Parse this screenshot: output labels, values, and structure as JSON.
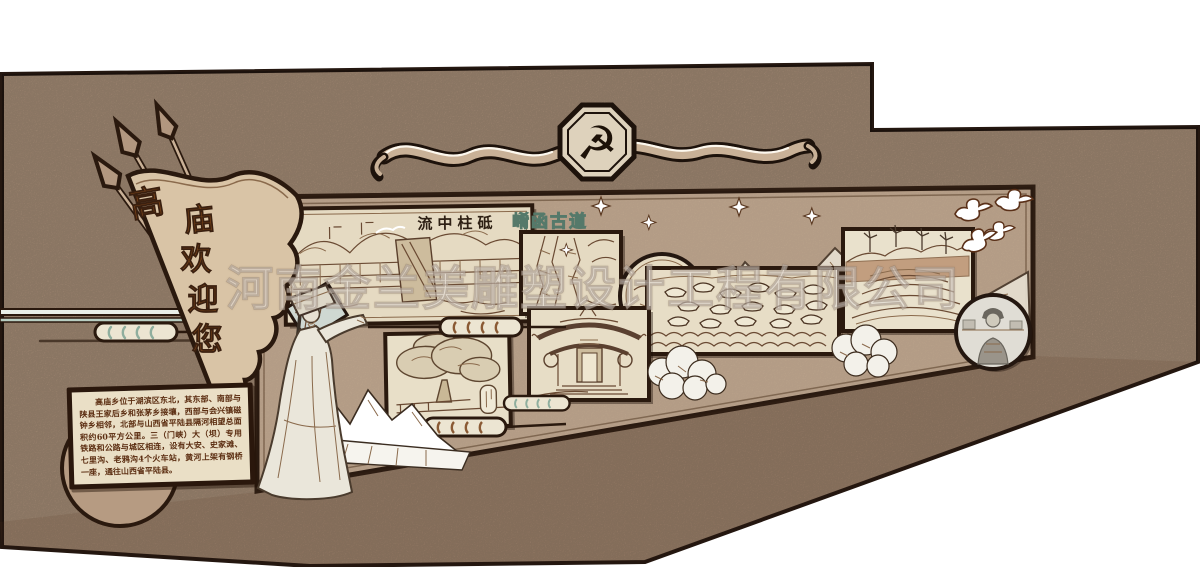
{
  "design": {
    "kind": "cultural-wall-rendering",
    "flag": {
      "text": "高庙欢迎您",
      "chars": [
        "高",
        "庙",
        "欢",
        "迎",
        "您"
      ]
    },
    "emblem": {
      "name": "hammer-and-sickle",
      "glyph": "☭"
    },
    "titles": {
      "dam": "流中柱砥",
      "ancient_road": "崤函古道"
    },
    "intro_panel": {
      "text": "高庙乡位于湖滨区东北，其东部、南部与陕县王家后乡和张茅乡接壤，西部与会兴镇磁钟乡相邻，北部与山西省平陆县隔河相望总面积约60平方公里。三（门峡）大（坝）专用铁路和公路与城区相连，设有大安、史家滩、七里沟、老鸦沟4个火车站，黄河上架有钢桥一座，通往山西省平陆县。"
    },
    "watermark": {
      "text": "河南金兰美雕塑设计工程有限公司"
    },
    "pictures": [
      {
        "id": "dam-etching",
        "label": "流中柱砥"
      },
      {
        "id": "ancient-road-etching",
        "label": "崤函古道"
      },
      {
        "id": "landscape-medallion",
        "label": ""
      },
      {
        "id": "ferry-boats-etching",
        "label": ""
      },
      {
        "id": "ancient-tree-etching",
        "label": ""
      },
      {
        "id": "temple-etching",
        "label": ""
      },
      {
        "id": "terraced-fields-etching",
        "label": ""
      },
      {
        "id": "farmer-portrait-photo",
        "label": ""
      }
    ],
    "colors": {
      "wall": "#b2977f",
      "board": "#c4ab92",
      "outline": "#2a190e",
      "frame_bg": "#e5dac2",
      "teal_accent": "#8fae9e",
      "flag_text": "#7c4418",
      "watermark": "rgba(255,255,255,0.48)"
    }
  }
}
